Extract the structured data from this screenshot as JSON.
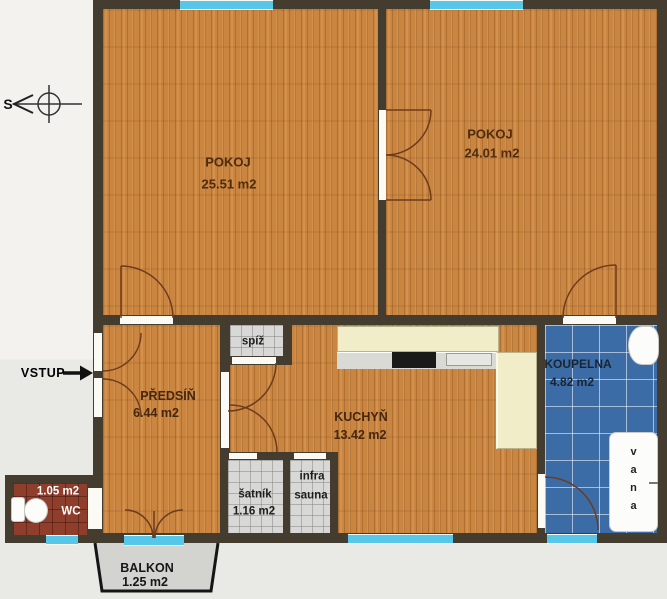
{
  "plan_title": "apartment-floor-plan",
  "rooms": {
    "pokoj1": {
      "name": "POKOJ",
      "area": "25.51 m2"
    },
    "pokoj2": {
      "name": "POKOJ",
      "area": "24.01 m2"
    },
    "predsin": {
      "name": "PŘEDSÍŇ",
      "area": "6.44 m2"
    },
    "kuchyn": {
      "name": "KUCHYŇ",
      "area": "13.42 m2"
    },
    "koupelna": {
      "name": "KOUPELNA",
      "area": "4.82 m2"
    },
    "wc": {
      "name": "WC",
      "area": "1.05 m2"
    },
    "spiz": {
      "name": "spíž"
    },
    "satnik": {
      "name": "šatník",
      "area": "1.16 m2"
    },
    "infra_sauna": {
      "line1": "infra",
      "line2": "sauna"
    },
    "balkon": {
      "name": "BALKON",
      "area": "1.25 m2"
    }
  },
  "annotations": {
    "entrance": "VSTUP",
    "compass_north": "S"
  },
  "fixtures": {
    "bathtub": "vana"
  },
  "colors": {
    "wall": "#443c2e",
    "wood_floor": "#ca8540",
    "bathroom_tile": "#3c6ca6",
    "wc_tile": "#8f3e2c",
    "utility_tile": "#d8d8d6",
    "window_glass": "#57c7e9",
    "balcony_floor": "#d3d3d0",
    "counter": "#f1edc8"
  }
}
